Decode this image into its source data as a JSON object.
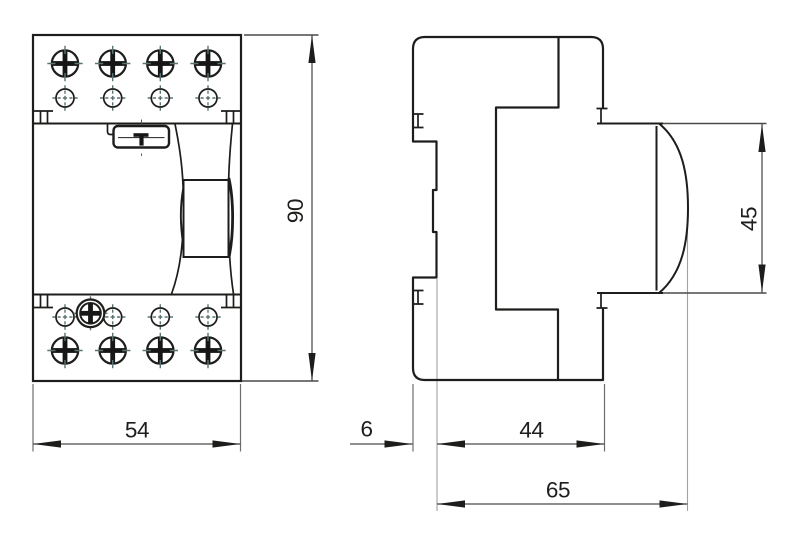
{
  "drawing": {
    "kind": "technical-dimension-drawing",
    "views": {
      "front": {
        "name": "front view (4-pole modular device)"
      },
      "side": {
        "name": "side profile view"
      }
    }
  },
  "dimensions": {
    "width": {
      "label": "54"
    },
    "height": {
      "label": "90"
    },
    "rail_offset": {
      "label": "6"
    },
    "depth_body": {
      "label": "44"
    },
    "depth_total": {
      "label": "65"
    },
    "front_height": {
      "label": "45"
    }
  },
  "colors": {
    "line": "#1d1d1b",
    "dimension": "#4a4a48",
    "extension": "#6e6e6c",
    "centerline": "#5c7473",
    "text": "#1d1d1b",
    "background": "#ffffff"
  }
}
